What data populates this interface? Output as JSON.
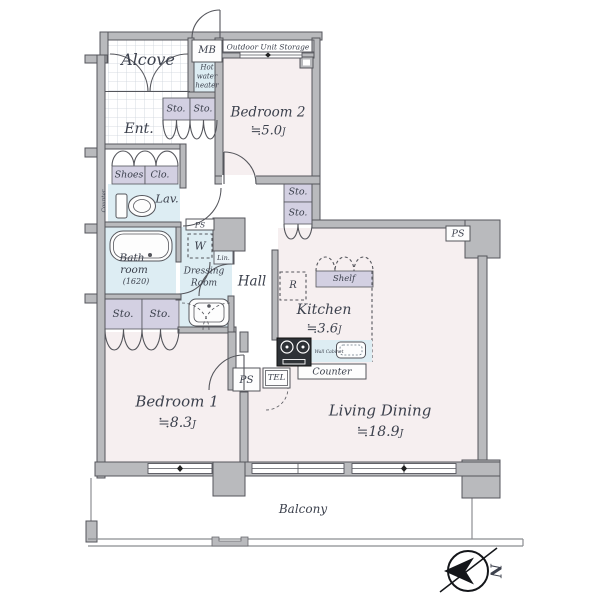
{
  "palette": {
    "wall": "#b9babd",
    "wallstroke": "#55565c",
    "pink": "#f6eff0",
    "blue": "#ddedf3",
    "lavender": "#d3d0e2",
    "text": "#3c414d",
    "linecol": "#55565c",
    "white": "#ffffff"
  },
  "rooms": {
    "bedroom1": {
      "name": "Bedroom 1",
      "area": "≒8.3"
    },
    "bedroom2": {
      "name": "Bedroom 2",
      "area": "≒5.0"
    },
    "kitchen": {
      "name": "Kitchen",
      "area": "≒3.6"
    },
    "living_dining": {
      "name": "Living Dining",
      "area": "≒18.9"
    },
    "unit_suffix": "J",
    "hall": "Hall",
    "ent": "Ent.",
    "alcove": "Alcove",
    "balcony": "Balcony",
    "lav": "Lav.",
    "bath": {
      "lines": [
        "Bath",
        "room",
        "(1620)"
      ]
    },
    "dressing": {
      "lines": [
        "Dressing",
        "Room"
      ]
    }
  },
  "fixtures": {
    "mb": "MB",
    "outdoor_unit_storage": "Outdoor Unit Storage",
    "hot_water_heater": [
      "Hot",
      "water",
      "heater"
    ],
    "storage": "Sto.",
    "shoes": "Shoes",
    "closet": "Clo.",
    "shoes_closet_note": "Shoes Clo.",
    "ps": "PS",
    "tel": "TEL",
    "w": "W",
    "lin": "Lin.",
    "r": "R",
    "shelf": "Shelf",
    "wall_cabinet": "Wall Cabinet",
    "counter": "Counter"
  },
  "compass": {
    "north": "N"
  }
}
